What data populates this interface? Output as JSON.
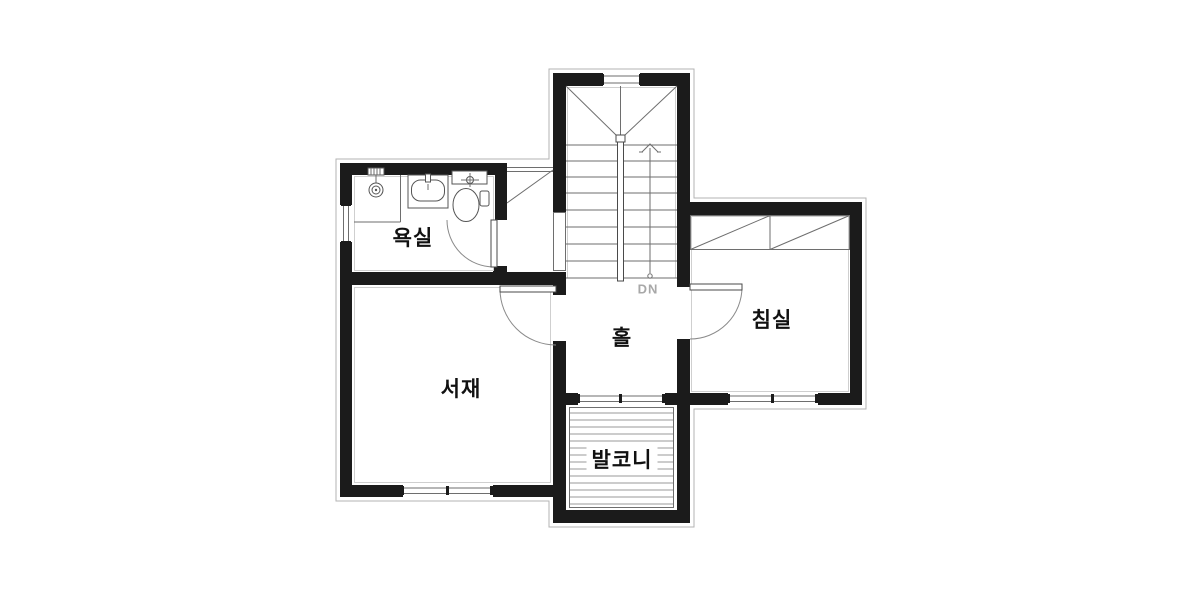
{
  "plan": {
    "title": "floor-plan",
    "labels": {
      "bathroom": "욕실",
      "study": "서재",
      "hall": "홀",
      "bedroom": "침실",
      "balcony": "발코니",
      "stairs_direction": "DN"
    },
    "fixtures": [
      "shower-icon",
      "sink-icon",
      "toilet-icon",
      "wardrobe-icon",
      "stairs-icon"
    ],
    "colors": {
      "wall": "#1b1b1b",
      "thin_line": "#6e6e6e",
      "exterior_outline": "#b3b3b3",
      "dn_text": "#a8a8a8",
      "label_text": "#111111",
      "background": "#ffffff"
    }
  }
}
